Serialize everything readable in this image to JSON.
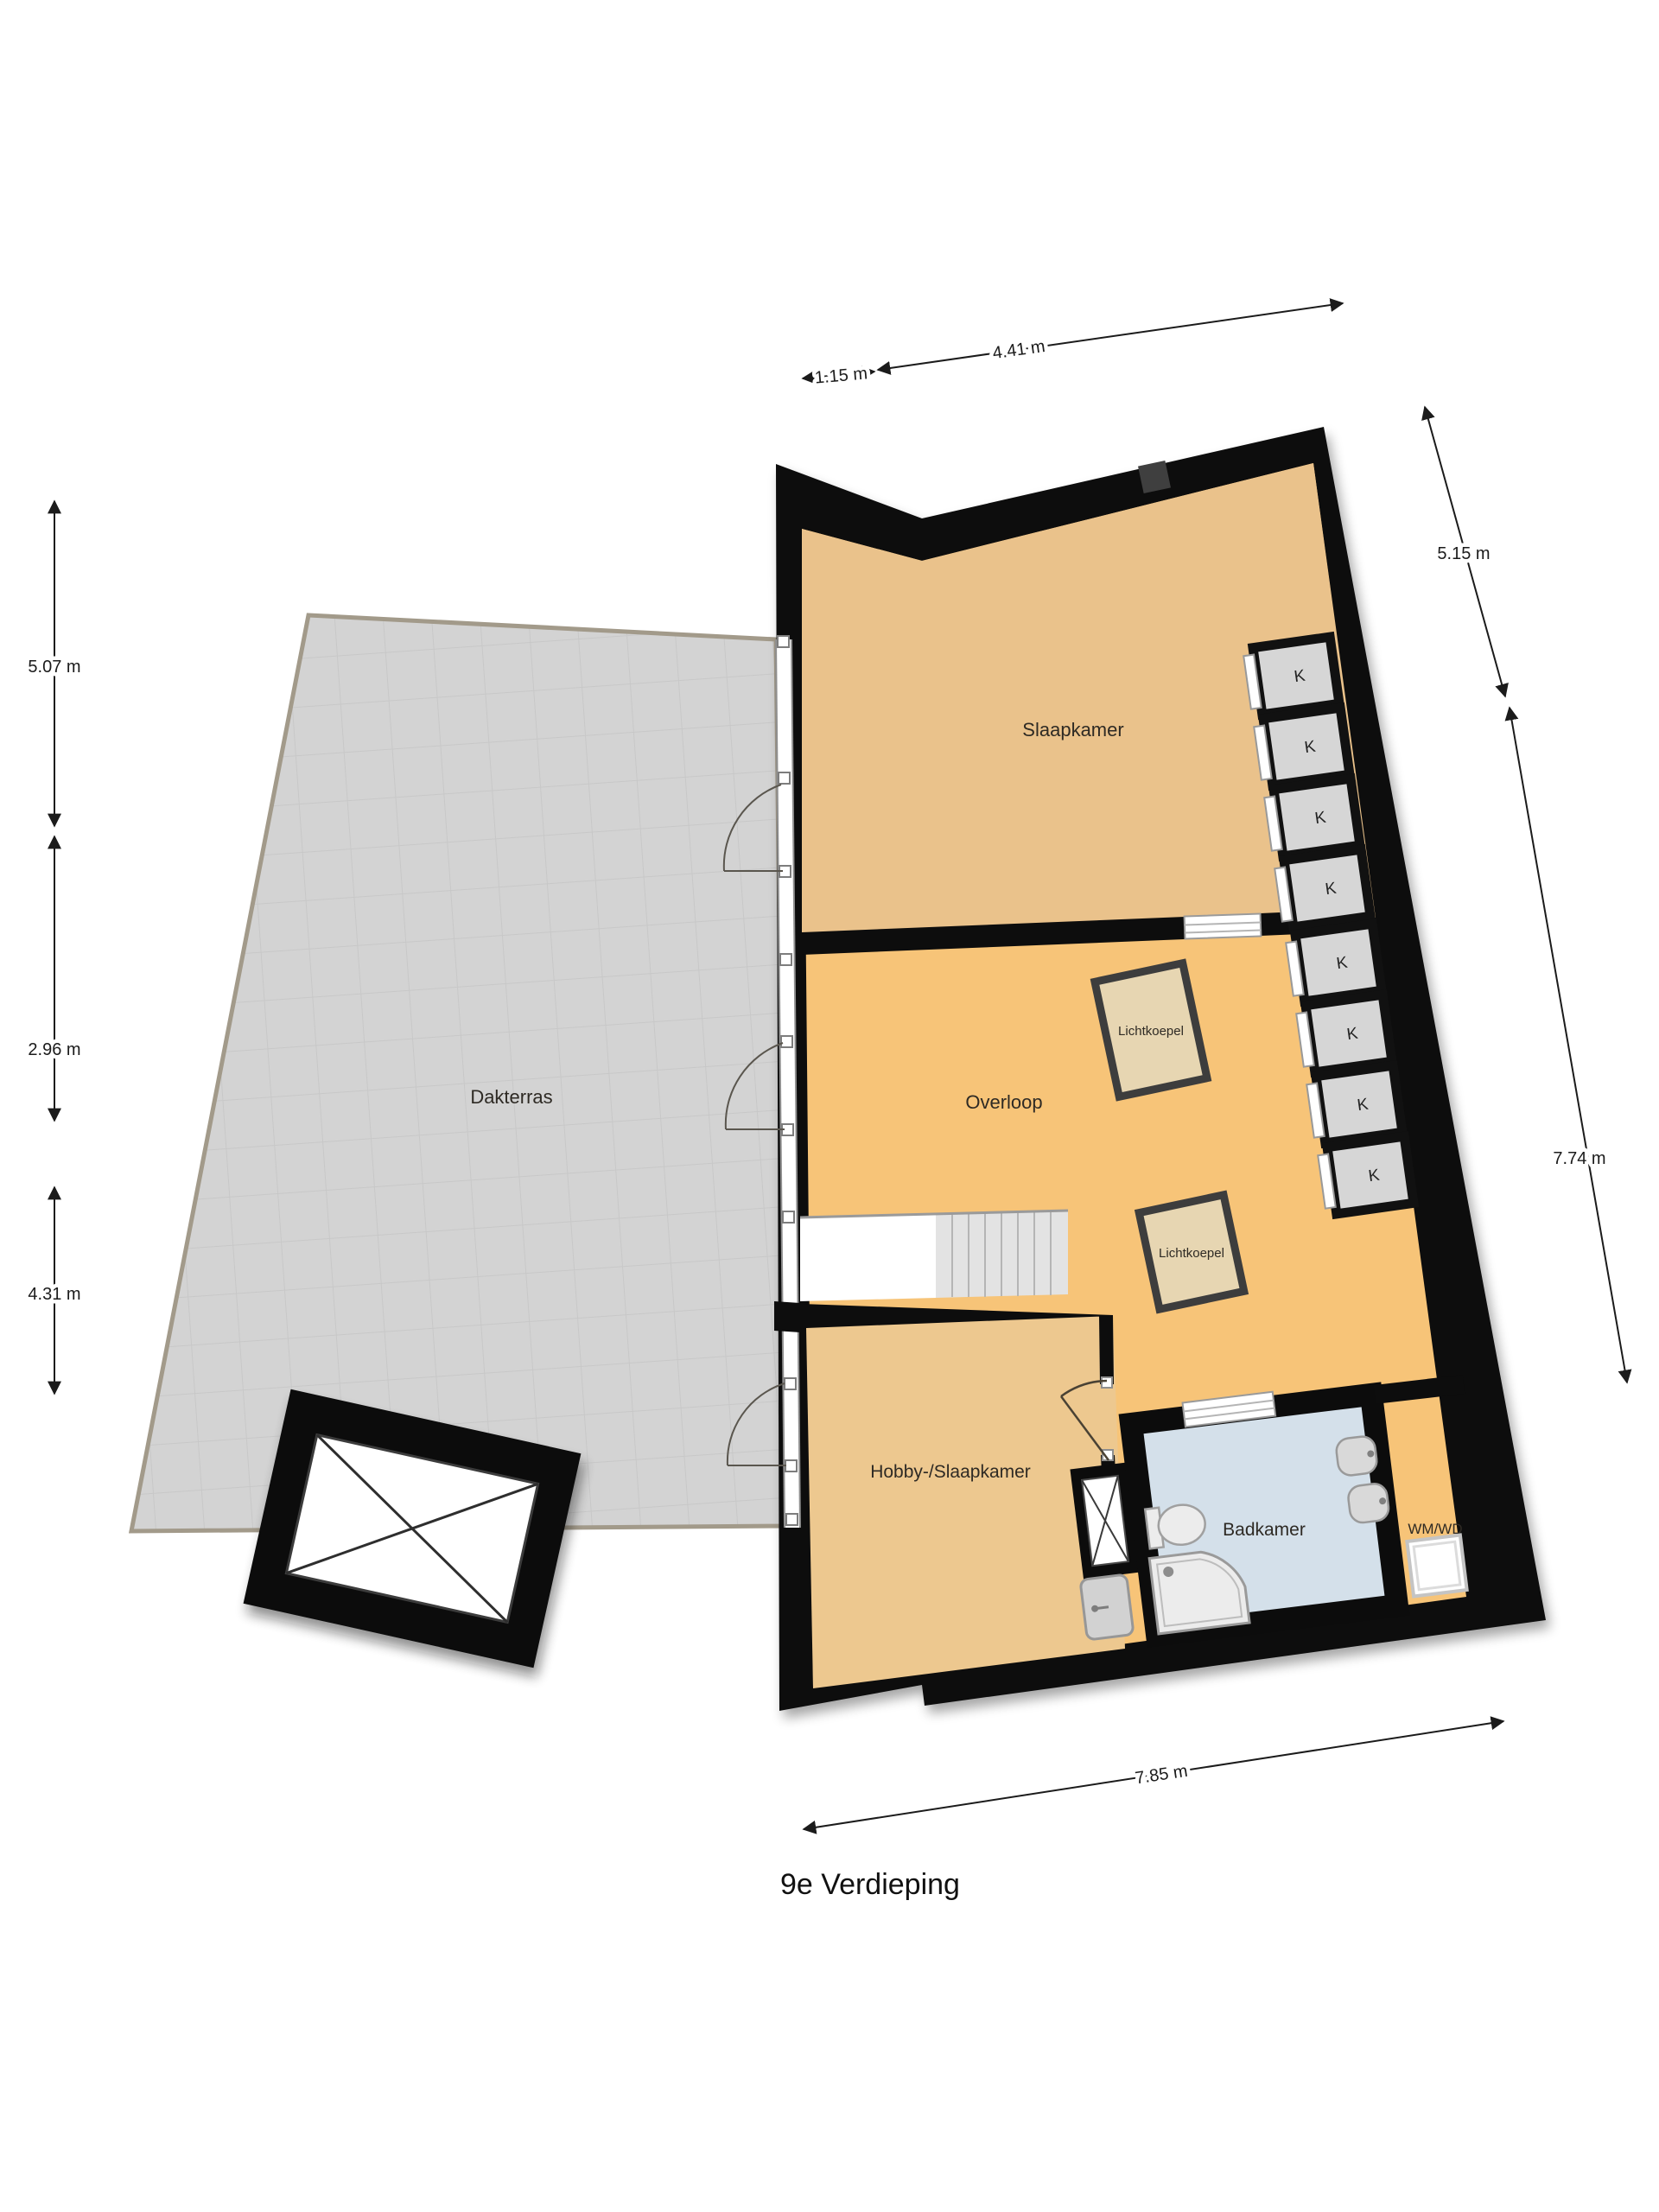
{
  "title": "9e Verdieping",
  "labels": {
    "terrace": "Dakterras",
    "bedroom": "Slaapkamer",
    "landing": "Overloop",
    "hobby": "Hobby-/Slaapkamer",
    "bathroom": "Badkamer",
    "skylight": "Lichtkoepel",
    "closet": "K",
    "washer": "WM/WD"
  },
  "dimensions": {
    "top_left": "1.15 m",
    "top_right": "4.41 m",
    "right_upper": "5.15 m",
    "right_lower": "7.74 m",
    "left_upper": "5.07 m",
    "left_middle": "2.96 m",
    "left_lower": "4.31 m",
    "bottom": "7.85 m"
  },
  "colors": {
    "wall": "#0d0d0d",
    "terrace_floor": "#d3d3d3",
    "terrace_border": "#a29a8a",
    "bedroom_floor": "#eac28b",
    "landing_floor": "#f7c478",
    "hobby_floor": "#edc88f",
    "bathroom_floor": "#d4e0ea",
    "closet_fill": "#d6d6d6",
    "skylight_fill": "#e7d6b2",
    "skylight_border": "#3d3d3d"
  }
}
